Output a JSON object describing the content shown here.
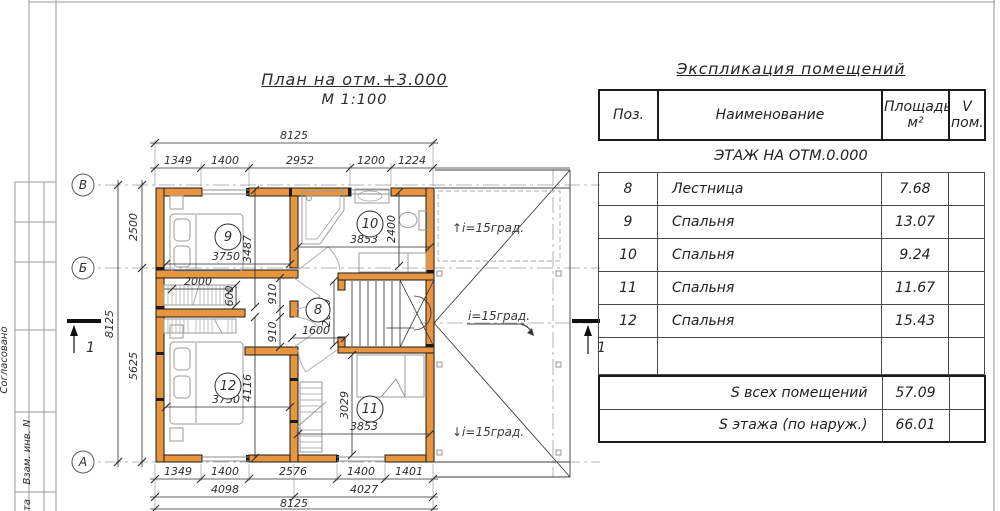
{
  "frame": {
    "stamp_side": "Согласовано",
    "stamp_vzam": "Взам. инв. N",
    "stamp_ta": "та"
  },
  "plan": {
    "title": "План на отм.+3.000",
    "scale_label": "М 1:100",
    "axis": {
      "v": "В",
      "b": "Б",
      "a": "А"
    },
    "section_no": "1",
    "rooms": {
      "r8": {
        "num": "8",
        "dim": "1600"
      },
      "r9": {
        "num": "9",
        "dim": "3750"
      },
      "r10": {
        "num": "10",
        "dim": "3853"
      },
      "r11": {
        "num": "11",
        "dim": "3853"
      },
      "r12": {
        "num": "12",
        "dim": "3750"
      }
    },
    "dims": {
      "top_total": "8125",
      "top": [
        "1349",
        "1400",
        "2952",
        "1200",
        "1224"
      ],
      "bottom": [
        "1349",
        "1400",
        "2576",
        "1400",
        "1401"
      ],
      "bottom_mid": [
        "4098",
        "4027"
      ],
      "bottom_total": "8125",
      "left_total": "8125",
      "left": [
        "2500",
        "5625"
      ],
      "v3487": "3487",
      "v4116": "4116",
      "v2400": "2400",
      "v3029": "3029",
      "w2000": "2000",
      "w600": "600",
      "d910a": "910",
      "d910b": "910",
      "s2000": "2000"
    },
    "slope_up": "↑i=15град.",
    "slope_right": "i=15град.",
    "slope_down": "↓i=15град."
  },
  "table": {
    "title": "Экспликация помещений",
    "col_pos": "Поз.",
    "col_name": "Наименование",
    "col_area_1": "Площадь",
    "col_area_2": "м²",
    "col_v_1": "V",
    "col_v_2": "пом.",
    "section": "ЭТАЖ НА ОТМ.0.000",
    "rows": [
      {
        "pos": "8",
        "name": "Лестница",
        "area": "7.68",
        "v": ""
      },
      {
        "pos": "9",
        "name": "Спальня",
        "area": "13.07",
        "v": ""
      },
      {
        "pos": "10",
        "name": "Спальня",
        "area": "9.24",
        "v": ""
      },
      {
        "pos": "11",
        "name": "Спальня",
        "area": "11.67",
        "v": ""
      },
      {
        "pos": "12",
        "name": "Спальня",
        "area": "15.43",
        "v": ""
      }
    ],
    "totals": [
      {
        "label": "S всех помещений",
        "value": "57.09"
      },
      {
        "label": "S этажа (по наруж.)",
        "value": "66.01"
      }
    ],
    "wall_color": "#e8953f"
  }
}
